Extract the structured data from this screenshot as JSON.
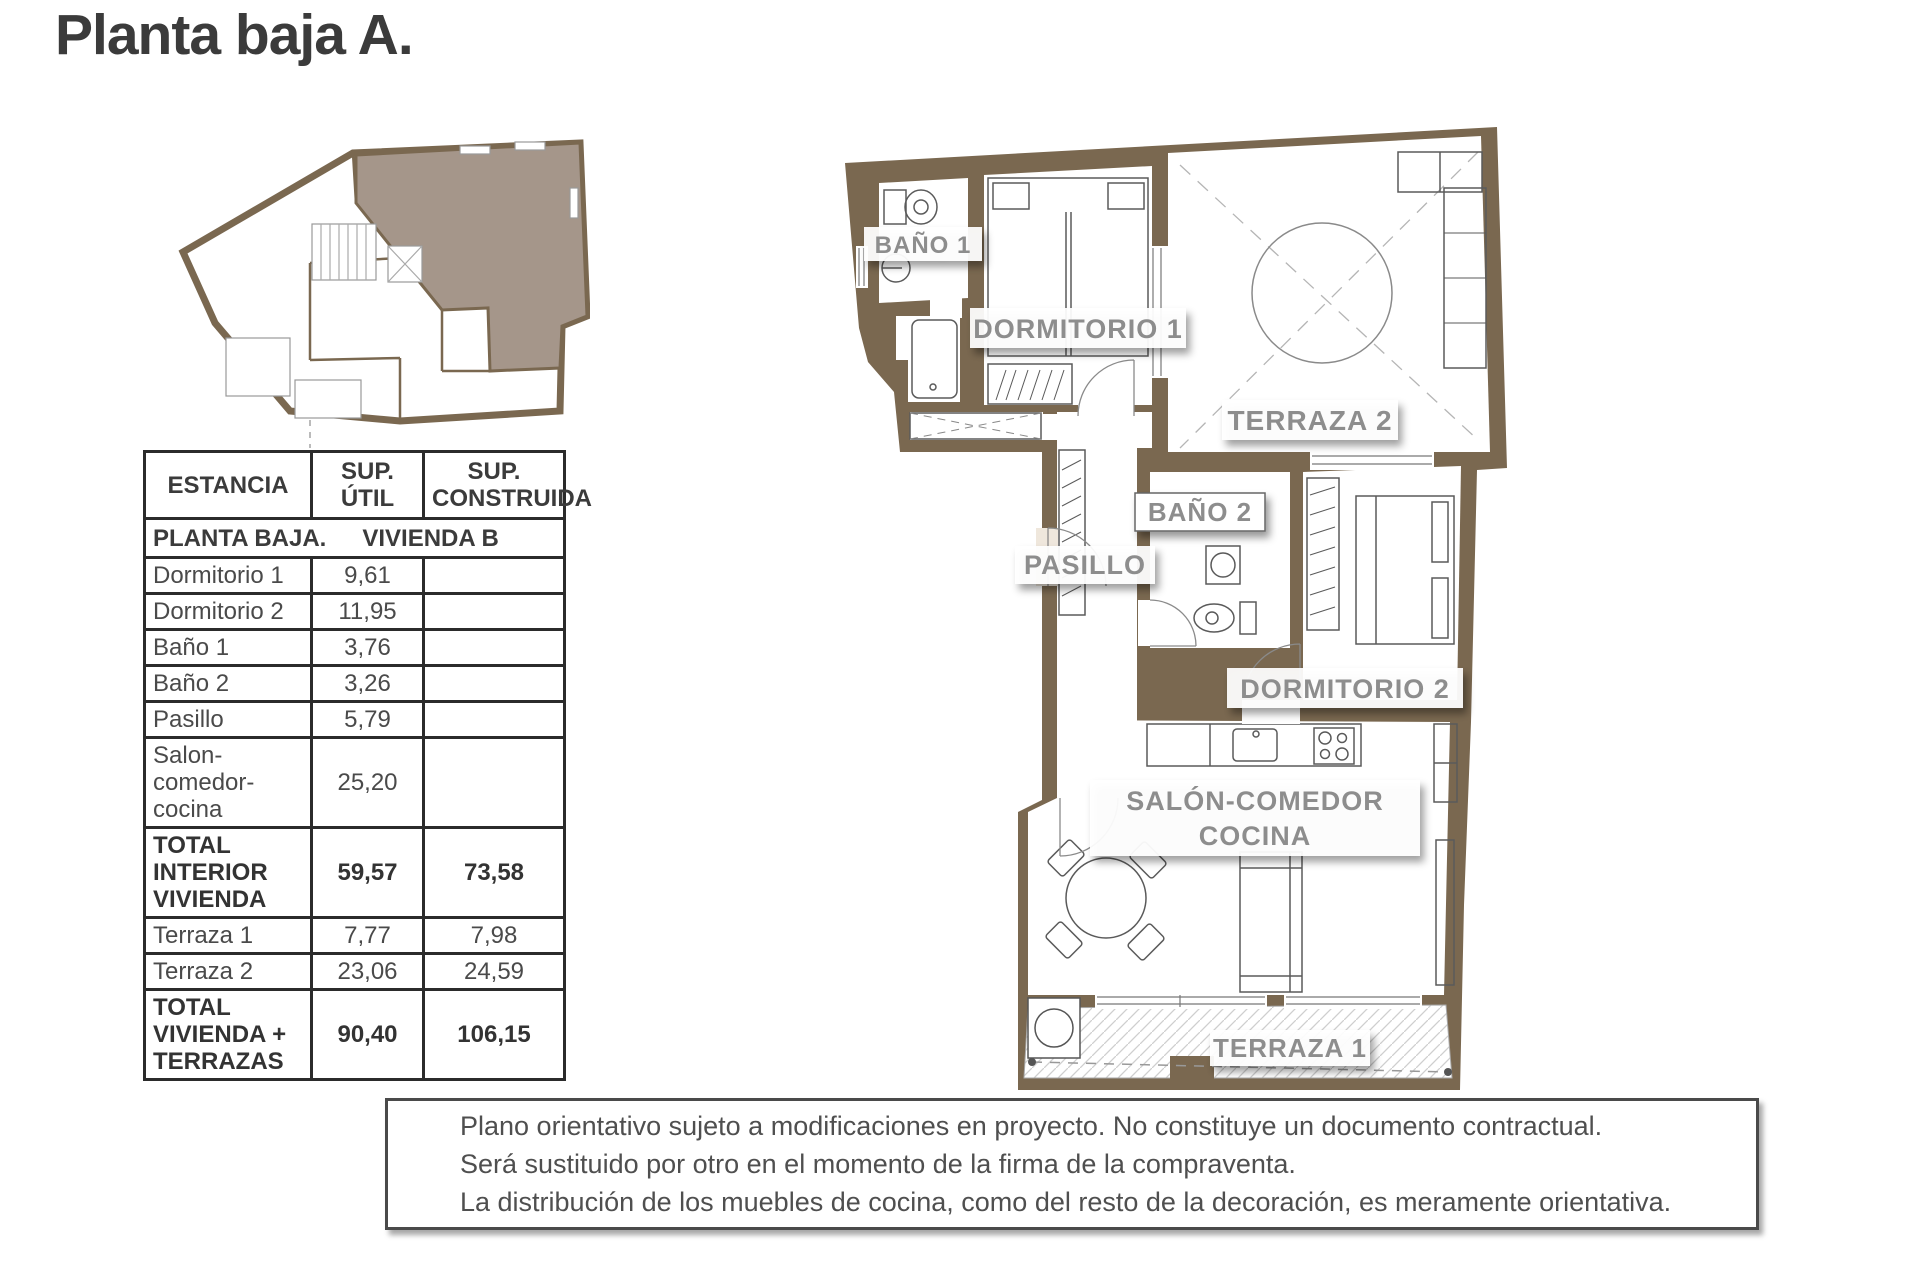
{
  "page": {
    "title": "Planta baja A."
  },
  "key_plan": {
    "description": "situation-plan-with-unit-highlight"
  },
  "table": {
    "headers": [
      "ESTANCIA",
      "SUP. ÚTIL",
      "SUP. CONSTRUIDA"
    ],
    "section": {
      "title": "PLANTA BAJA.",
      "subtitle": "VIVIENDA B"
    },
    "rows": [
      {
        "name": "Dormitorio 1",
        "util": "9,61",
        "construida": "",
        "bold": false
      },
      {
        "name": "Dormitorio 2",
        "util": "11,95",
        "construida": "",
        "bold": false
      },
      {
        "name": "Baño 1",
        "util": "3,76",
        "construida": "",
        "bold": false
      },
      {
        "name": "Baño 2",
        "util": "3,26",
        "construida": "",
        "bold": false
      },
      {
        "name": "Pasillo",
        "util": "5,79",
        "construida": "",
        "bold": false
      },
      {
        "name": "Salon-comedor-cocina",
        "util": "25,20",
        "construida": "",
        "bold": false
      },
      {
        "name": "TOTAL INTERIOR VIVIENDA",
        "util": "59,57",
        "construida": "73,58",
        "bold": true
      },
      {
        "name": "Terraza 1",
        "util": "7,77",
        "construida": "7,98",
        "bold": false
      },
      {
        "name": "Terraza 2",
        "util": "23,06",
        "construida": "24,59",
        "bold": false
      },
      {
        "name": "TOTAL VIVIENDA + TERRAZAS",
        "util": "90,40",
        "construida": "106,15",
        "bold": true
      }
    ]
  },
  "floorplan": {
    "labels": {
      "bano1": "BAÑO 1",
      "dormitorio1": "DORMITORIO 1",
      "terraza2": "TERRAZA 2",
      "bano2": "BAÑO 2",
      "pasillo": "PASILLO",
      "dormitorio2": "DORMITORIO 2",
      "salon_line1": "SALÓN-COMEDOR",
      "salon_line2": "COCINA",
      "terraza1": "TERRAZA 1"
    }
  },
  "disclaimer": {
    "lines": [
      "Plano orientativo sujeto a modificaciones en proyecto. No constituye un documento contractual.",
      "Será sustituido por otro en el momento de la firma de la compraventa.",
      "La distribución de los muebles de cocina, como del resto de la decoración, es meramente orientativa."
    ]
  },
  "colors": {
    "wall": "#7a6850",
    "unit_highlight": "#a5968a",
    "label_gray": "#8d8d8d",
    "table_border": "#2b2b2b",
    "text_dark": "#3b3b3b"
  }
}
